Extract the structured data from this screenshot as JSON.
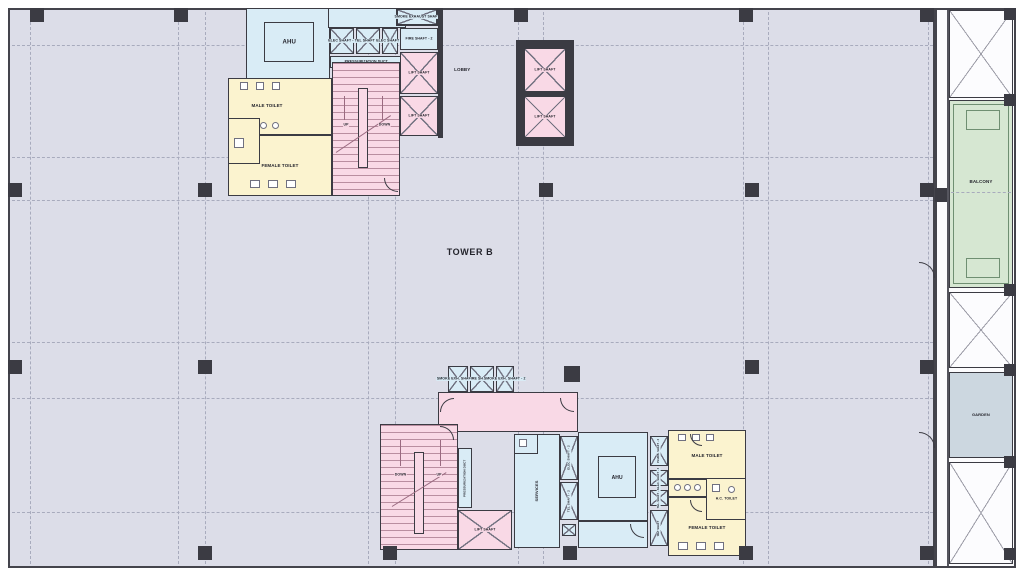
{
  "title": "TOWER B",
  "colors": {
    "floor": "#dcdde8",
    "wall": "#3b3b43",
    "room_blue": "#d9ecf6",
    "room_pink": "#f9d9e6",
    "room_yellow": "#fbf3cf",
    "balcony_green": "#d6e7d2",
    "garden_gray": "#ccd7e0",
    "grid_dashed": "#a8abbd"
  },
  "labels": {
    "lobby": "LOBBY",
    "ahu": "AHU",
    "lift_shaft": "LIFT SHAFT",
    "fire_shaft_2": "FIRE SHAFT - 2",
    "smoke_exhaust_shaft": "SMOKE EXHAUST SHAFT",
    "press_duct": "PRESSURIZATION DUCT",
    "elec_shaft_1": "ELEC SHAFT - 1",
    "tel_shaft_1": "TEL SHAFT - 1",
    "elec_shaft_2": "ELEC SHAFT - 2",
    "plumbing_shaft_1": "PLUMBING SHAFT - 1",
    "male_toilet": "MALE TOILET",
    "female_toilet": "FEMALE TOILET",
    "hc_toilet": "H.C. TOILET",
    "up": "UP",
    "down": "DOWN",
    "balcony": "BALCONY",
    "garden": "GARDEN",
    "smoke_shaft_1": "SMOKE EXH. SHAFT - 1",
    "fire_shaft_1": "FIRE SHAFT - 1",
    "smoke_shaft_2": "SMOKE EXH. SHAFT - 2",
    "services": "SERVICES",
    "tel_shaft_2": "TEL SHAFT - 2",
    "plumb_shaft_2": "PLUMB. SHAFT - 2",
    "elec_shaft_3": "ELEC. SHAFT - 3",
    "tel_shaft_3": "TEL. SHAFT - 3",
    "wet_shaft": "WET SHAFT"
  }
}
